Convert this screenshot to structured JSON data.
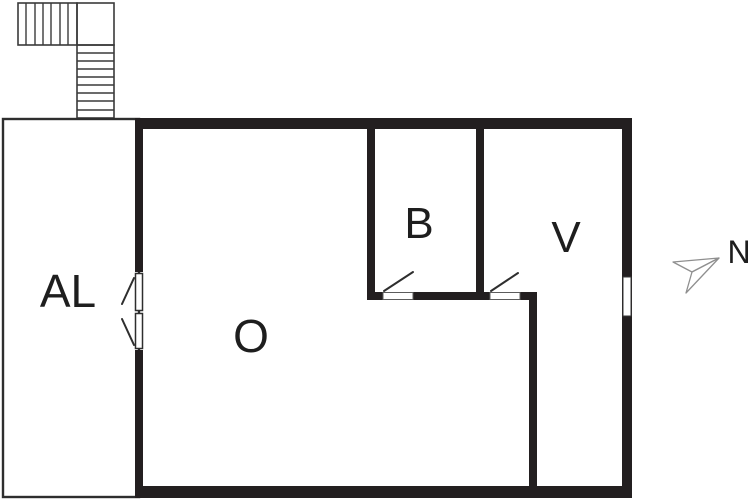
{
  "document": {
    "type": "floor-plan"
  },
  "rooms": [
    {
      "code": "AL"
    },
    {
      "code": "O"
    },
    {
      "code": "B"
    },
    {
      "code": "V"
    }
  ],
  "compass": {
    "label": "N"
  },
  "colors": {
    "wall": "#231f20",
    "thin_line": "#2e2e2e",
    "stair_line": "#3a3a3a",
    "arrow": "#8f8f8f",
    "text": "#1e1e1e",
    "background": "#ffffff"
  }
}
